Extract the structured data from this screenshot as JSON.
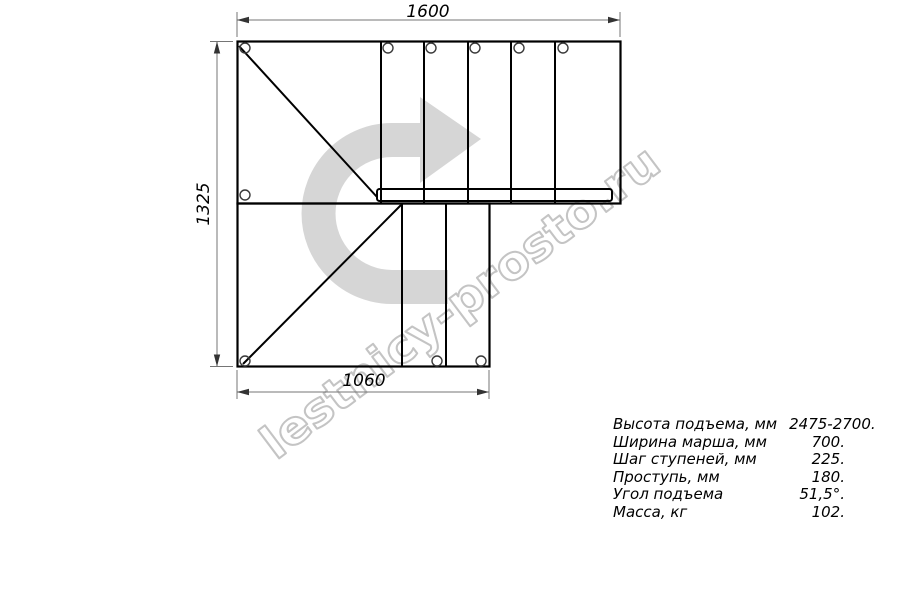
{
  "drawing": {
    "dim_top": "1600",
    "dim_left": "1325",
    "dim_bottom": "1060"
  },
  "watermark": {
    "text": "lestnicy-prosto.ru",
    "color": "#c4c4c4"
  },
  "direction_arrow": {
    "meaning": "stair ascent direction, turning right",
    "color": "#d6d6d6"
  },
  "specs": {
    "rows": [
      {
        "label": "Высота подъема, мм",
        "value": "2475-2700."
      },
      {
        "label": "Ширина марша, мм",
        "value": "700."
      },
      {
        "label": "Шаг ступеней, мм",
        "value": "225."
      },
      {
        "label": "Проступь, мм",
        "value": "180."
      },
      {
        "label": "Угол подъема",
        "value": "51,5°."
      },
      {
        "label": "Масса, кг",
        "value": "102."
      }
    ]
  },
  "colors": {
    "line": "#000000",
    "dimension_line": "#757575",
    "arrow_fill": "#d6d6d6",
    "watermark_stroke": "#c4c4c4",
    "background": "#ffffff"
  }
}
